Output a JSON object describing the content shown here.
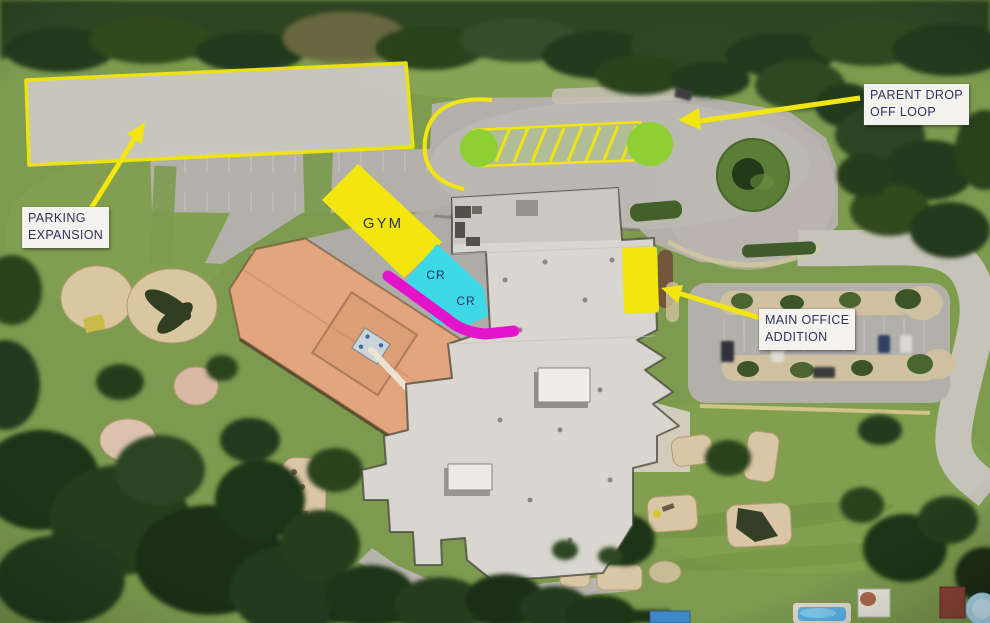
{
  "colors": {
    "annotation_yellow": "#f2e60e",
    "dropoff_green": "#8ed032",
    "classroom_cyan": "#3cd8e6",
    "corridor_magenta": "#f816de",
    "expansion_gray": "#cbc9c2",
    "label_bg": "#f4f2ec",
    "label_text": "#2f3360"
  },
  "annotations": {
    "parking_expansion": {
      "line1": "PARKING",
      "line2": "EXPANSION"
    },
    "parent_drop_off": {
      "line1": "PARENT DROP",
      "line2": "OFF LOOP"
    },
    "main_office_addition": {
      "line1": "MAIN OFFICE",
      "line2": "ADDITION"
    },
    "gym": {
      "label": "GYM"
    },
    "classrooms": {
      "labels": [
        "CR",
        "CR"
      ]
    }
  }
}
